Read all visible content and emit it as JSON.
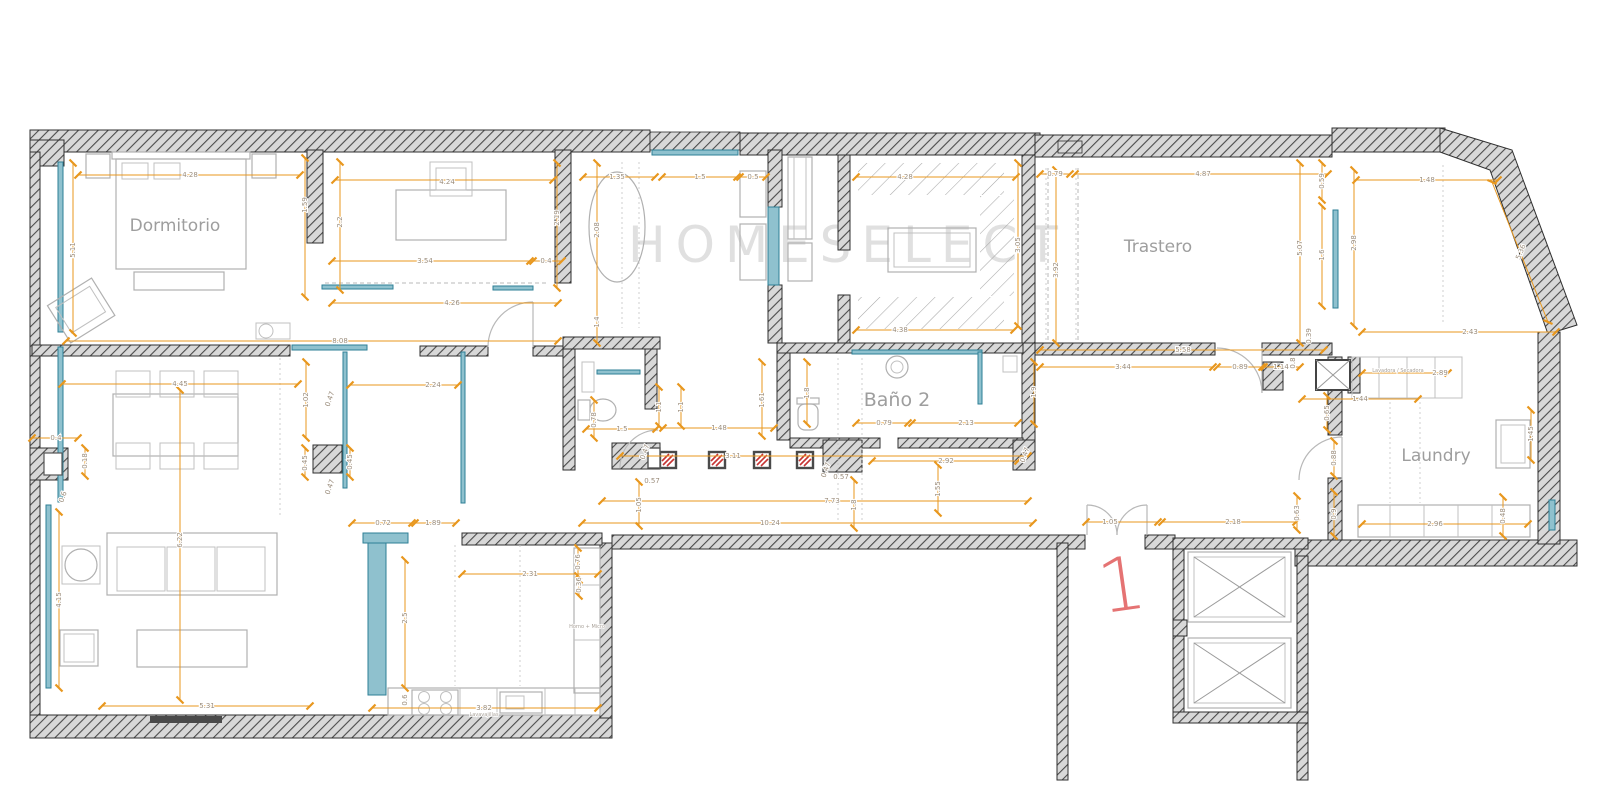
{
  "watermark": "HOMESELECT",
  "unit_label": "1",
  "room_labels": {
    "dormitorio": "Dormitorio",
    "trastero": "Trastero",
    "bano2": "Baño 2",
    "laundry": "Laundry"
  },
  "small_labels": {
    "lavadora_secadora": "Lavadora / Secadora",
    "horno_micro": "Horno + Micro",
    "lavavajillas": "Lavavajillas"
  },
  "colors": {
    "dimension_line": "#E8971E",
    "dimension_text": "#9b8d7c",
    "window_glazing": "#2E7F96",
    "wall_hatch": "#4b4b4b",
    "furniture": "#b0b0b0",
    "room_label": "#9e9e9e",
    "column_marker_red": "#C63434",
    "unit_number_red": "#e57373",
    "watermark_gray": "#c7c7c7"
  },
  "dimensions": [
    {
      "x": 190,
      "y": 175,
      "t": "4.28"
    },
    {
      "x": 73,
      "y": 250,
      "t": "5.11",
      "r": -90
    },
    {
      "x": 305,
      "y": 205,
      "t": "1.59",
      "r": -90
    },
    {
      "x": 340,
      "y": 222,
      "t": "2.2",
      "r": -90
    },
    {
      "x": 447,
      "y": 182,
      "t": "4.24"
    },
    {
      "x": 557,
      "y": 218,
      "t": "2.19",
      "r": -90
    },
    {
      "x": 425,
      "y": 261,
      "t": "3.54"
    },
    {
      "x": 546,
      "y": 261,
      "t": "0.4"
    },
    {
      "x": 452,
      "y": 303,
      "t": "4.26"
    },
    {
      "x": 340,
      "y": 341,
      "t": "8.08"
    },
    {
      "x": 597,
      "y": 230,
      "t": "2.08",
      "r": -90
    },
    {
      "x": 617,
      "y": 177,
      "t": "1.35"
    },
    {
      "x": 700,
      "y": 177,
      "t": "1.5"
    },
    {
      "x": 753,
      "y": 177,
      "t": "0.5"
    },
    {
      "x": 597,
      "y": 322,
      "t": "1.4",
      "r": -90
    },
    {
      "x": 905,
      "y": 177,
      "t": "4.28"
    },
    {
      "x": 900,
      "y": 330,
      "t": "4.38"
    },
    {
      "x": 1018,
      "y": 245,
      "t": "3.05",
      "r": -90
    },
    {
      "x": 1055,
      "y": 174,
      "t": "0.79"
    },
    {
      "x": 1203,
      "y": 174,
      "t": "4.87"
    },
    {
      "x": 1056,
      "y": 270,
      "t": "3.92",
      "r": -90
    },
    {
      "x": 1300,
      "y": 248,
      "t": "5.07",
      "r": -90
    },
    {
      "x": 1322,
      "y": 181,
      "t": "0.59",
      "r": -90
    },
    {
      "x": 1322,
      "y": 255,
      "t": "1.6",
      "r": -90
    },
    {
      "x": 1183,
      "y": 350,
      "t": "5.58"
    },
    {
      "x": 1123,
      "y": 367,
      "t": "3.44"
    },
    {
      "x": 1240,
      "y": 367,
      "t": "0.89"
    },
    {
      "x": 1281,
      "y": 367,
      "t": "1.14"
    },
    {
      "x": 1293,
      "y": 363,
      "t": "0.8",
      "r": -90
    },
    {
      "x": 1427,
      "y": 180,
      "t": "1.48"
    },
    {
      "x": 1354,
      "y": 243,
      "t": "2.98",
      "r": -90
    },
    {
      "x": 1521,
      "y": 252,
      "t": "5.36",
      "r": -68
    },
    {
      "x": 1470,
      "y": 332,
      "t": "2.43"
    },
    {
      "x": 1440,
      "y": 373,
      "t": "2.89"
    },
    {
      "x": 1360,
      "y": 399,
      "t": "1.44"
    },
    {
      "x": 1327,
      "y": 413,
      "t": "0.65",
      "r": -90
    },
    {
      "x": 1334,
      "y": 458,
      "t": "0.88",
      "r": -90
    },
    {
      "x": 1334,
      "y": 514,
      "t": "0.9",
      "r": -90
    },
    {
      "x": 1297,
      "y": 513,
      "t": "0.63",
      "r": -90
    },
    {
      "x": 1435,
      "y": 524,
      "t": "2.96"
    },
    {
      "x": 1503,
      "y": 516,
      "t": "0.48",
      "r": -90
    },
    {
      "x": 1531,
      "y": 434,
      "t": "1.45",
      "r": -90
    },
    {
      "x": 884,
      "y": 423,
      "t": "0.79"
    },
    {
      "x": 966,
      "y": 423,
      "t": "2.13"
    },
    {
      "x": 1034,
      "y": 392,
      "t": "1.9",
      "r": -90
    },
    {
      "x": 762,
      "y": 400,
      "t": "1.61",
      "r": -90
    },
    {
      "x": 807,
      "y": 393,
      "t": "1.8",
      "r": -90
    },
    {
      "x": 659,
      "y": 407,
      "t": "1.1",
      "r": -90
    },
    {
      "x": 681,
      "y": 407,
      "t": "1.1",
      "r": -90
    },
    {
      "x": 622,
      "y": 429,
      "t": "1.5"
    },
    {
      "x": 719,
      "y": 428,
      "t": "1.48"
    },
    {
      "x": 733,
      "y": 456,
      "t": "3.11"
    },
    {
      "x": 946,
      "y": 461,
      "t": "2.92"
    },
    {
      "x": 841,
      "y": 477,
      "t": "0.57"
    },
    {
      "x": 652,
      "y": 481,
      "t": "0.57"
    },
    {
      "x": 832,
      "y": 501,
      "t": "7.73"
    },
    {
      "x": 854,
      "y": 505,
      "t": "1.8",
      "r": -90
    },
    {
      "x": 938,
      "y": 489,
      "t": "1.55",
      "r": -90
    },
    {
      "x": 770,
      "y": 523,
      "t": "10.24"
    },
    {
      "x": 639,
      "y": 505,
      "t": "1.05",
      "r": -90
    },
    {
      "x": 594,
      "y": 420,
      "t": "0.78",
      "r": -90
    },
    {
      "x": 645,
      "y": 452,
      "t": "0.47",
      "r": -70
    },
    {
      "x": 826,
      "y": 470,
      "t": "0.47",
      "r": -70
    },
    {
      "x": 1025,
      "y": 455,
      "t": "0.47",
      "r": -70
    },
    {
      "x": 180,
      "y": 384,
      "t": "4.45"
    },
    {
      "x": 433,
      "y": 385,
      "t": "2.24"
    },
    {
      "x": 306,
      "y": 400,
      "t": "1.02",
      "r": -90
    },
    {
      "x": 330,
      "y": 399,
      "t": "0.47",
      "r": -70
    },
    {
      "x": 56,
      "y": 438,
      "t": "0.4"
    },
    {
      "x": 85,
      "y": 461,
      "t": "0.18",
      "r": -90
    },
    {
      "x": 305,
      "y": 463,
      "t": "0.45",
      "r": -90
    },
    {
      "x": 350,
      "y": 462,
      "t": "0.45",
      "r": -90
    },
    {
      "x": 330,
      "y": 487,
      "t": "0.47",
      "r": -70
    },
    {
      "x": 63,
      "y": 497,
      "t": "0.6",
      "r": -70
    },
    {
      "x": 180,
      "y": 540,
      "t": "6.22",
      "r": -90
    },
    {
      "x": 59,
      "y": 600,
      "t": "4.15",
      "r": -90
    },
    {
      "x": 383,
      "y": 523,
      "t": "0.72"
    },
    {
      "x": 433,
      "y": 523,
      "t": "1.89"
    },
    {
      "x": 207,
      "y": 706,
      "t": "5.31"
    },
    {
      "x": 530,
      "y": 574,
      "t": "2.31"
    },
    {
      "x": 578,
      "y": 562,
      "t": "0.76",
      "r": -90
    },
    {
      "x": 579,
      "y": 585,
      "t": "0.36",
      "r": -90
    },
    {
      "x": 484,
      "y": 708,
      "t": "3.82"
    },
    {
      "x": 405,
      "y": 618,
      "t": "2.5",
      "r": -90
    },
    {
      "x": 405,
      "y": 700,
      "t": "0.6",
      "r": -90
    },
    {
      "x": 1110,
      "y": 522,
      "t": "1.05"
    },
    {
      "x": 1233,
      "y": 522,
      "t": "2.18"
    },
    {
      "x": 1309,
      "y": 336,
      "t": "0.39",
      "r": -90
    }
  ]
}
